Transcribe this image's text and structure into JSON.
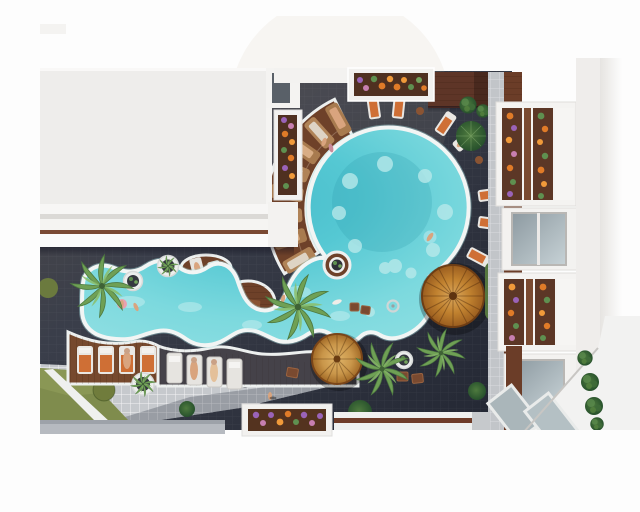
{
  "scene": {
    "label": "Top-down aerial 3D architectural rendering of a resort courtyard with a freeform turquoise pool",
    "view": "top-down aerial",
    "render_style": "photorealistic 3D visualization"
  },
  "palette": {
    "pool_water": "#5ecdd8",
    "pool_water_shallow": "#9fe2e4",
    "pool_coping_white": "#f2f5f4",
    "courtyard_tile_dark": "#343844",
    "wood_deck": "#74492f",
    "wood_band_dark": "#5e3527",
    "parasol_amber": "#c07a2e",
    "palm_green": "#6fa055",
    "hedge_green": "#4e7d42",
    "lawn_olive": "#7f8c4d",
    "plaza_tile_gray": "#c6c9cd",
    "building_white": "#efedeb",
    "window_glass": "#9aa6ad",
    "flower_orange": "#e07b28",
    "flower_purple": "#9a63b8",
    "lounger_cushion_orange": "#cf6f35",
    "lounger_cushion_white": "#e9e7e3"
  },
  "objects": {
    "pool_sections": [
      "round main pool",
      "lagoon with fountain",
      "winding lazy river"
    ],
    "pool_features": [
      "fan of wooden swim-up lounger steps",
      "deck islands with planters",
      "in-water fountain ring"
    ],
    "counts": {
      "wooden_fan_loungers": 8,
      "orange_loungers": 11,
      "white_loungers": 6,
      "parasols": 2,
      "palm_trees": 5,
      "round_planters": 5,
      "flower_planter_boxes": 5,
      "hedge_bushes": 24,
      "shade_trees_and_shrubs": 6,
      "swimmers": 5,
      "people_on_deck": 3,
      "side_tables_and_ottomans": 8
    },
    "buildings": [
      "white residential block upper-left",
      "white residential block with balconies on right"
    ],
    "ground_surfaces": [
      "dark charcoal tile pool deck",
      "light gray tile plaza",
      "olive lawn with white path",
      "brown wood decking"
    ]
  }
}
